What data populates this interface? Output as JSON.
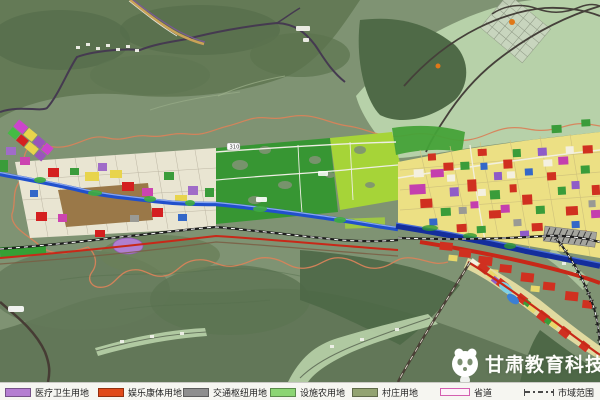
{
  "map": {
    "road_label": "310",
    "watermark_text": "甘肃教育科技"
  },
  "legend": {
    "items": [
      {
        "id": "medical",
        "label": "医疗卫生用地",
        "swatch_color": "#b57ed1",
        "swatch_style": "fill"
      },
      {
        "id": "recreation",
        "label": "娱乐康体用地",
        "swatch_color": "#e04a1a",
        "swatch_style": "fill"
      },
      {
        "id": "transport-hub",
        "label": "交通枢纽用地",
        "swatch_color": "#8e8e8e",
        "swatch_style": "fill"
      },
      {
        "id": "facility-agriculture",
        "label": "设施农用地",
        "swatch_color": "#8cd573",
        "swatch_style": "fill"
      },
      {
        "id": "village",
        "label": "村庄用地",
        "swatch_color": "#93a371",
        "swatch_style": "fill"
      },
      {
        "id": "provincial-road",
        "label": "省道",
        "swatch_color": "#d45fb0",
        "swatch_style": "outline"
      },
      {
        "id": "city-boundary",
        "label": "市域范围",
        "swatch_color": "#4a4a4a",
        "swatch_style": "dash-dot"
      }
    ]
  },
  "colors": {
    "terrain_base": "#7f9373",
    "forest_dark": "#4f6a47",
    "valley_pale": "#b7d1a9",
    "farmland_green": "#379633",
    "bright_farmland": "#a6d438",
    "urban_cream": "#e9e5d2",
    "urban_yellow": "#ece084",
    "commercial_red": "#d03020",
    "river_blue": "#2150cc",
    "deep_river_blue": "#142e9c",
    "boundary_orange": "#d8835a",
    "railway_black": "#1d1d1d"
  }
}
